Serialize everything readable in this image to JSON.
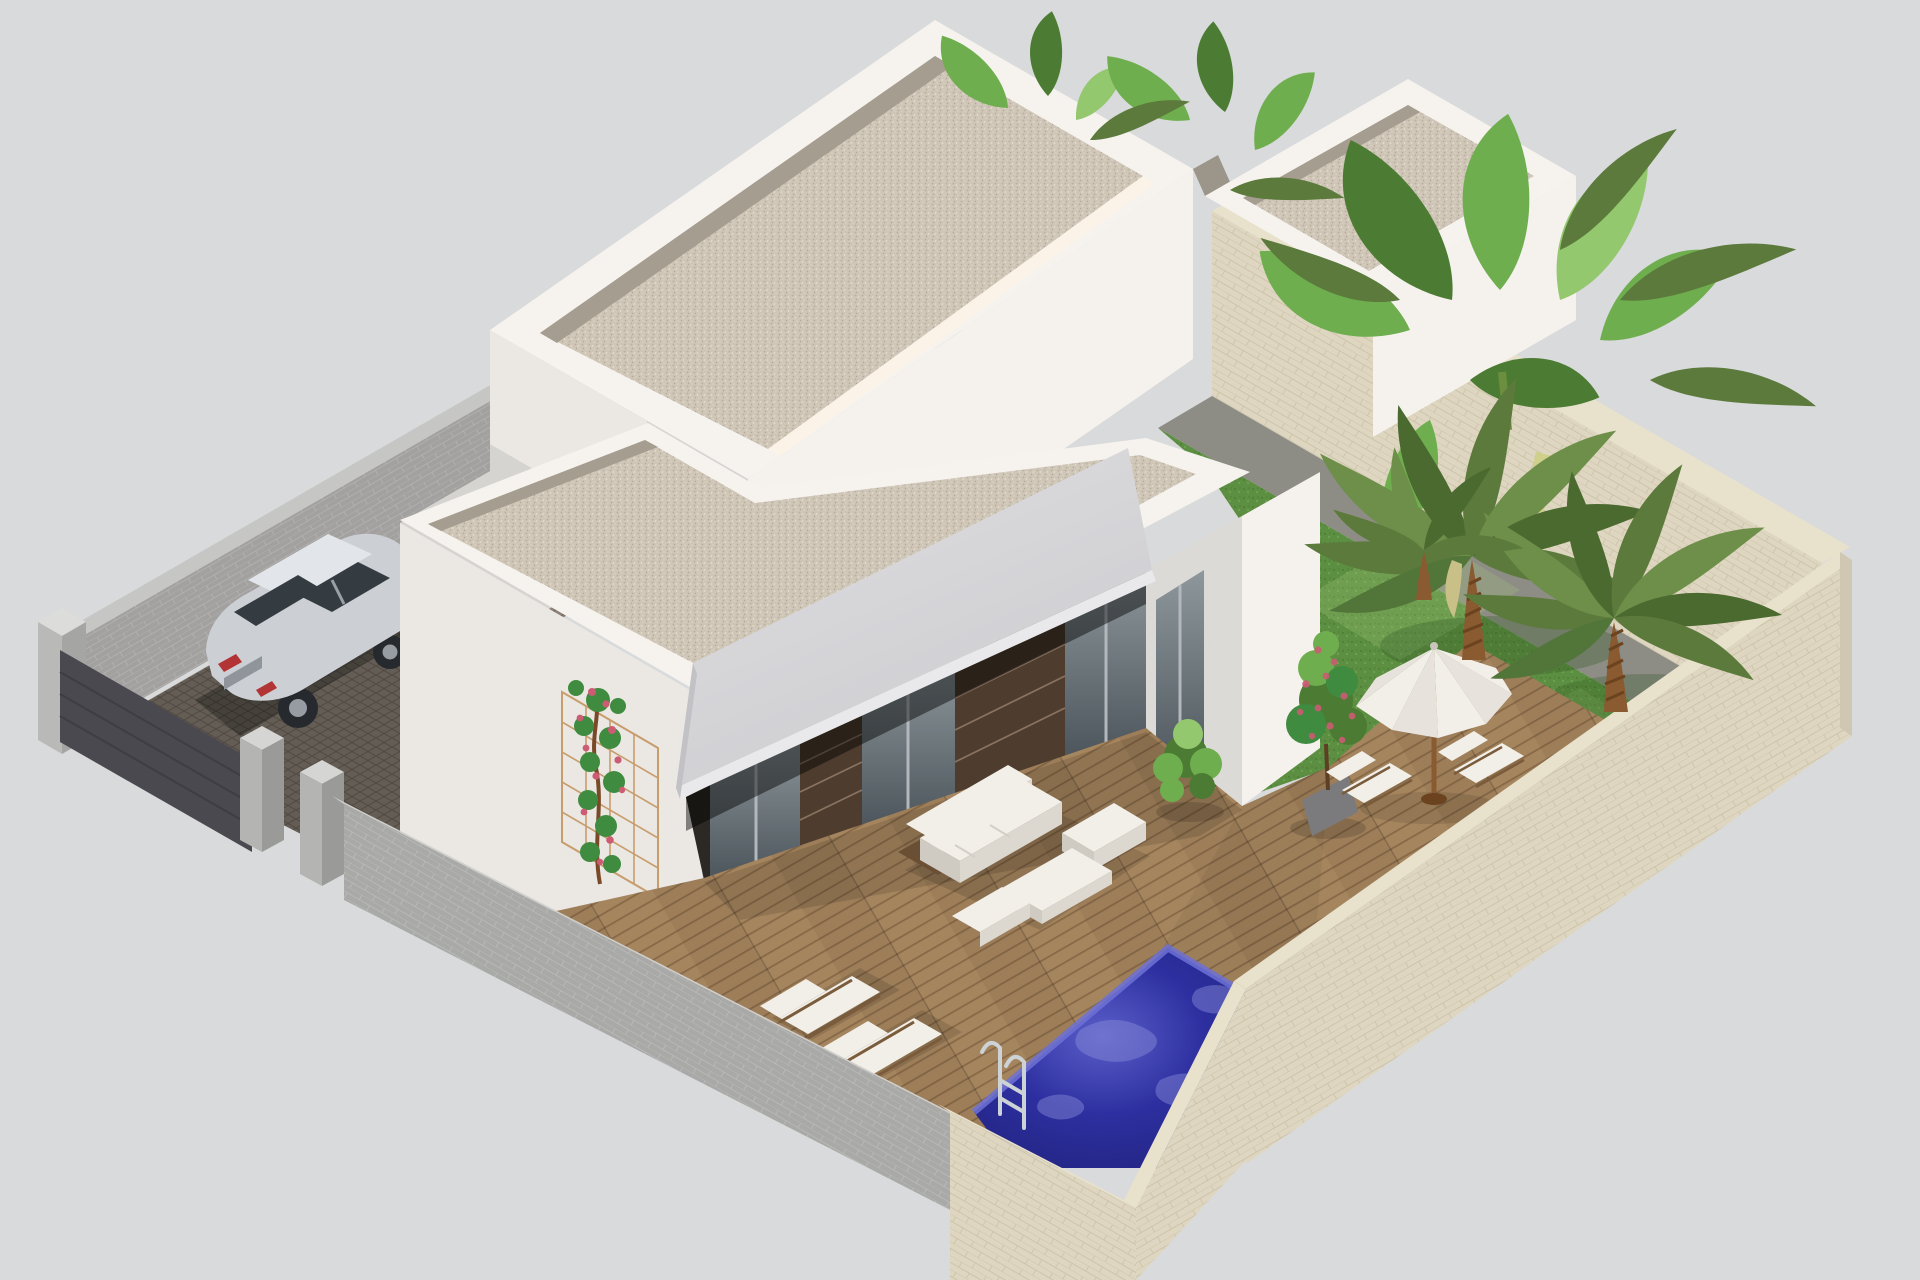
{
  "scene": {
    "type": "3d-architectural-render",
    "subject": "Isometric aerial rendering of a modern white flat-roof villa with gravel roof terraces, covered porch with awning, wooden sun deck, mosaic swimming pool, tropical garden with palm and banana trees, stone boundary walls, and a silver SUV parked in the cobbled driveway",
    "view": "isometric-aerial",
    "objects": [
      "white villa with two flat gravel roofs",
      "gray canvas awning over porch",
      "glass sliding doors with dark brown brick piers",
      "wooden deck terrace",
      "white outdoor sofa set with coffee table and ottomans",
      "two sun loungers by the pool",
      "white parasol with two deck chairs",
      "potted green shrub and potted pink flowering shrub",
      "climbing rose on wooden trellis",
      "yellow-green hedge along the side wall",
      "blue mosaic swimming pool with chrome ladder",
      "lawn with two palm trees and banana plants",
      "gray block boundary wall with gate pillars",
      "cream stone boundary wall with chamfered corner",
      "silver SUV on cobblestone driveway"
    ]
  },
  "colors": {
    "bg": "#d9dadb",
    "parapet": "#f6f3ef",
    "parapet_warm": "#fbf3e7",
    "gravel": "#cfc6b7",
    "gravel_dark": "#a59d90",
    "wall_bright": "#f5f2ee",
    "wall_lit": "#ebe8e4",
    "wall_mid": "#dcdad7",
    "wall_shade": "#d6d4d1",
    "awning": "#d8d8da",
    "awning_fascia": "#e9e9eb",
    "awning_side": "#c2c2c6",
    "glass": "#8e979c",
    "glass_dark": "#4d565c",
    "frame": "#b2b8bc",
    "brick": "#4e3d2f",
    "brick_line": "#8a7360",
    "deck": "#a5855e",
    "deck_line": "#876948",
    "pool": "#2d2fa0",
    "pool_deep": "#1f2178",
    "pool_light": "#5a5ec8",
    "pool_tile": "#6d71d6",
    "grass": "#5d8f42",
    "grass_light": "#a8cc7f",
    "grass_shadow": "#2e5722",
    "stone_beige": "#ded6c0",
    "stone_beige_light": "#e8e1cc",
    "stone_beige_line": "#cdc4aa",
    "stone_gray": "#a9a9a7",
    "stone_gray_line": "#bcbcba",
    "wall_dark": "#4a4950",
    "cobble": "#8b8177",
    "cobble_line": "#6f655b",
    "brickwall": "#a2a19f",
    "brickwall_line": "#b5b4b2",
    "car_body": "#ccd0d5",
    "car_roof": "#e2e6ea",
    "car_window": "#343b41",
    "car_red": "#b23434",
    "wheel": "#26292d",
    "rim": "#969ca2",
    "chrome": "#ccd2d6",
    "leaf": "#6fae4e",
    "leaf_dark": "#4c7c33",
    "leaf_light": "#93c86e",
    "frond": "#5c7a3c",
    "trunk": "#8a5a30",
    "trunk_dark": "#6b431f",
    "rose_green": "#3f8b3f",
    "rose_pink": "#cc5b74",
    "hedge": "#b3ac45",
    "hedge_light": "#cdc75b",
    "hedge_dark": "#968d33",
    "pot": "#7b7b7d",
    "furn_white": "#f2efe9",
    "furn_shade": "#dcd8d0",
    "furn_shade2": "#cfcbc3",
    "wood": "#7a5c3c",
    "soil": "#6b4f35",
    "path_dark": "#55504b"
  }
}
